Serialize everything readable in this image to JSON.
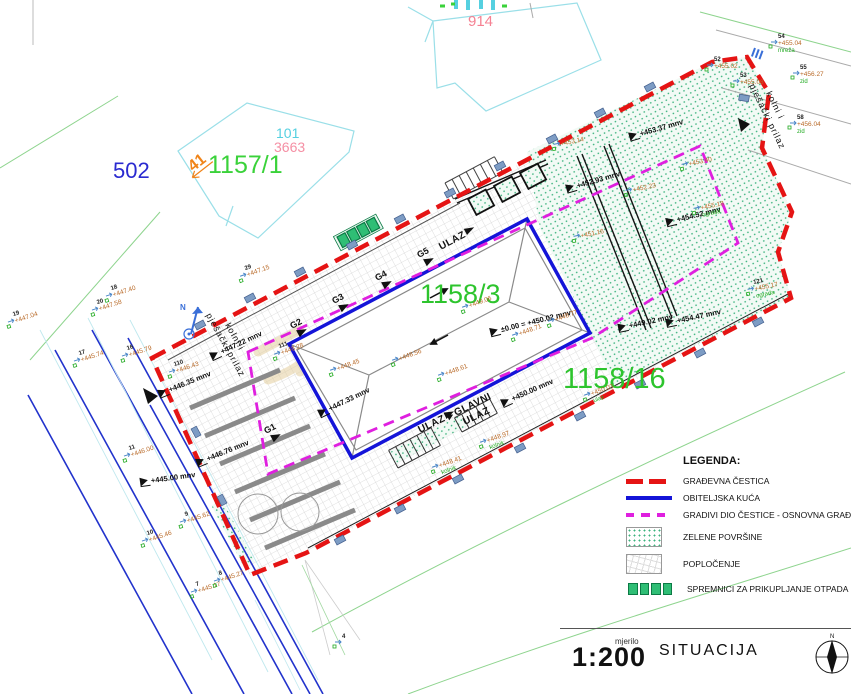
{
  "colors": {
    "boundary_red": "#e51414",
    "house_blue": "#1414d8",
    "buildable_magenta": "#df1fdf",
    "parcel_label_green": "#2dc42d",
    "green_area_dot": "#3cb37e",
    "bin_green": "#2fbe75",
    "cadastre_cyan": "#9adfe8"
  },
  "labels": {
    "p502": "502",
    "p1157_1": "1157/1",
    "p41": "41",
    "p101": "101",
    "p3663": "3663",
    "p914": "914",
    "p1158_3": "1158/3",
    "p1158_16": "1158/16"
  },
  "roads": {
    "line1": "kolni i",
    "line2": "pješački prilaz"
  },
  "entrances": {
    "side": "ULAZ",
    "bottom": "ULAZ",
    "main_line1": "GLAVNI",
    "main_line2": "ULAZ"
  },
  "north_letter": "N",
  "plan": {
    "g_marks": [
      {
        "t": "G1",
        "x": 266,
        "y": 434,
        "r": -28
      },
      {
        "t": "G2",
        "x": 292,
        "y": 329,
        "r": -28
      },
      {
        "t": "G3",
        "x": 334,
        "y": 304,
        "r": -28
      },
      {
        "t": "G4",
        "x": 377,
        "y": 281,
        "r": -28
      },
      {
        "t": "G5",
        "x": 419,
        "y": 258,
        "r": -28
      }
    ],
    "elevations": [
      {
        "t": "+447.22 mnv",
        "x": 222,
        "y": 352,
        "r": -25
      },
      {
        "t": "+446.35 mnv",
        "x": 170,
        "y": 390,
        "r": -22
      },
      {
        "t": "+445.00 mnv",
        "x": 152,
        "y": 481,
        "r": -8
      },
      {
        "t": "+446.76 mnv",
        "x": 208,
        "y": 459,
        "r": -22
      },
      {
        "t": "+447.33 mnv",
        "x": 330,
        "y": 409,
        "r": -26
      },
      {
        "t": "+450.00 mnv",
        "x": 513,
        "y": 399,
        "r": -24
      },
      {
        "t": "±0.00 = +450.02 mnv",
        "x": 502,
        "y": 330,
        "r": -14
      },
      {
        "t": "+452.93 mnv",
        "x": 578,
        "y": 186,
        "r": -16
      },
      {
        "t": "+453.37 mnv",
        "x": 641,
        "y": 134,
        "r": -16
      },
      {
        "t": "+454.52 mnv",
        "x": 678,
        "y": 220,
        "r": -14
      },
      {
        "t": "+454.47 mnv",
        "x": 678,
        "y": 321,
        "r": -12
      },
      {
        "t": "+449.02 mnv",
        "x": 630,
        "y": 326,
        "r": -12
      }
    ],
    "survey_points": [
      {
        "n": "19",
        "v": "+447.04",
        "x": 14,
        "y": 318,
        "r": -18
      },
      {
        "n": "18",
        "v": "+447.40",
        "x": 112,
        "y": 292,
        "r": -18
      },
      {
        "n": "20",
        "v": "+447.58",
        "x": 98,
        "y": 306,
        "r": -18
      },
      {
        "n": "17",
        "v": "+445.74",
        "x": 80,
        "y": 357,
        "r": -18
      },
      {
        "n": "16",
        "v": "+445.79",
        "x": 128,
        "y": 352,
        "r": -18
      },
      {
        "n": "11",
        "v": "+446.00",
        "x": 130,
        "y": 452,
        "r": -18
      },
      {
        "n": "10",
        "v": "+445.46",
        "x": 148,
        "y": 537,
        "r": -18
      },
      {
        "n": "9",
        "v": "+445.62",
        "x": 186,
        "y": 518,
        "r": -18
      },
      {
        "n": "7",
        "v": "+445.17",
        "x": 197,
        "y": 588,
        "r": -18
      },
      {
        "n": "8",
        "v": "+445.27",
        "x": 220,
        "y": 577,
        "r": -18
      },
      {
        "n": "110",
        "v": "+446.43",
        "x": 175,
        "y": 368,
        "r": -18
      },
      {
        "n": "111",
        "v": "+448.28",
        "x": 280,
        "y": 350,
        "r": -20
      },
      {
        "n": "29",
        "v": "+447.15",
        "x": 246,
        "y": 272,
        "r": -20
      },
      {
        "v": "+448.45",
        "x": 336,
        "y": 366,
        "r": -20
      },
      {
        "v": "+448.56",
        "x": 398,
        "y": 356,
        "r": -20
      },
      {
        "v": "+448.61",
        "x": 444,
        "y": 371,
        "r": -20
      },
      {
        "v": "+448.71",
        "x": 518,
        "y": 331,
        "r": -20
      },
      {
        "v": "+448.77",
        "x": 554,
        "y": 317,
        "r": -20
      },
      {
        "v": "+449.06",
        "x": 468,
        "y": 303,
        "r": -20
      },
      {
        "v": "+448.41",
        "d": "kolnik",
        "x": 438,
        "y": 463,
        "r": -20
      },
      {
        "v": "+448.97",
        "d": "kolnik",
        "x": 486,
        "y": 438,
        "r": -20
      },
      {
        "v": "+450.03",
        "d": "ulaz",
        "x": 590,
        "y": 391,
        "r": -20
      },
      {
        "n": "121",
        "v": "+455.17",
        "d": "ograda",
        "x": 754,
        "y": 286,
        "r": -12
      },
      {
        "v": "+455.18",
        "d": "ograda",
        "x": 700,
        "y": 205,
        "r": -12
      },
      {
        "v": "+453.14",
        "x": 560,
        "y": 141,
        "r": -12
      },
      {
        "n": "54",
        "v": "+455.04",
        "d": "mreža",
        "x": 778,
        "y": 40,
        "r": 0
      },
      {
        "n": "55",
        "v": "+456.27",
        "d": "zid",
        "x": 800,
        "y": 71,
        "r": 0
      },
      {
        "n": "58",
        "v": "+456.04",
        "d": "zid",
        "x": 797,
        "y": 121,
        "r": 0
      },
      {
        "n": "53",
        "v": "+455.08",
        "x": 740,
        "y": 79,
        "r": 0
      },
      {
        "n": "52",
        "v": "+455.02",
        "x": 714,
        "y": 63,
        "r": 0
      },
      {
        "v": "+452.23",
        "x": 632,
        "y": 187,
        "r": -12
      },
      {
        "v": "+451.16",
        "x": 580,
        "y": 233,
        "r": -12
      },
      {
        "v": "+453.40",
        "x": 688,
        "y": 161,
        "r": -12
      },
      {
        "n": "4",
        "x": 342,
        "y": 640,
        "r": 0
      }
    ],
    "blue_marks": [
      {
        "x": 200,
        "y": 325,
        "r": -28
      },
      {
        "x": 250,
        "y": 298,
        "r": -28
      },
      {
        "x": 300,
        "y": 272,
        "r": -28
      },
      {
        "x": 352,
        "y": 245,
        "r": -28
      },
      {
        "x": 400,
        "y": 219,
        "r": -28
      },
      {
        "x": 450,
        "y": 193,
        "r": -28
      },
      {
        "x": 500,
        "y": 166,
        "r": -28
      },
      {
        "x": 552,
        "y": 139,
        "r": -28
      },
      {
        "x": 600,
        "y": 113,
        "r": -28
      },
      {
        "x": 650,
        "y": 87,
        "r": -28
      },
      {
        "x": 340,
        "y": 540,
        "r": -28
      },
      {
        "x": 400,
        "y": 509,
        "r": -28
      },
      {
        "x": 458,
        "y": 479,
        "r": -28
      },
      {
        "x": 520,
        "y": 448,
        "r": -28
      },
      {
        "x": 580,
        "y": 416,
        "r": -28
      },
      {
        "x": 640,
        "y": 384,
        "r": -28
      },
      {
        "x": 700,
        "y": 353,
        "r": -28
      },
      {
        "x": 758,
        "y": 322,
        "r": -28
      },
      {
        "x": 744,
        "y": 98,
        "r": 10
      },
      {
        "x": 196,
        "y": 432,
        "r": 62
      },
      {
        "x": 222,
        "y": 500,
        "r": 62
      }
    ]
  },
  "legend": {
    "title": "LEGENDA:",
    "items": [
      {
        "label": "GRAĐEVNA ČESTICA"
      },
      {
        "label": "OBITELJSKA KUĆA"
      },
      {
        "label": "GRADIVI DIO ČESTICE - OSNOVNA GRAĐEVINA"
      },
      {
        "label": "ZELENE POVRŠINE"
      },
      {
        "label": "POPLOČENJE"
      },
      {
        "label": "SPREMNICI ZA PRIKUPLJANJE OTPADA"
      }
    ]
  },
  "titleblock": {
    "scale_caption": "mjerilo",
    "scale_value": "1:200",
    "drawing_title": "SITUACIJA",
    "compass_n": "N"
  }
}
